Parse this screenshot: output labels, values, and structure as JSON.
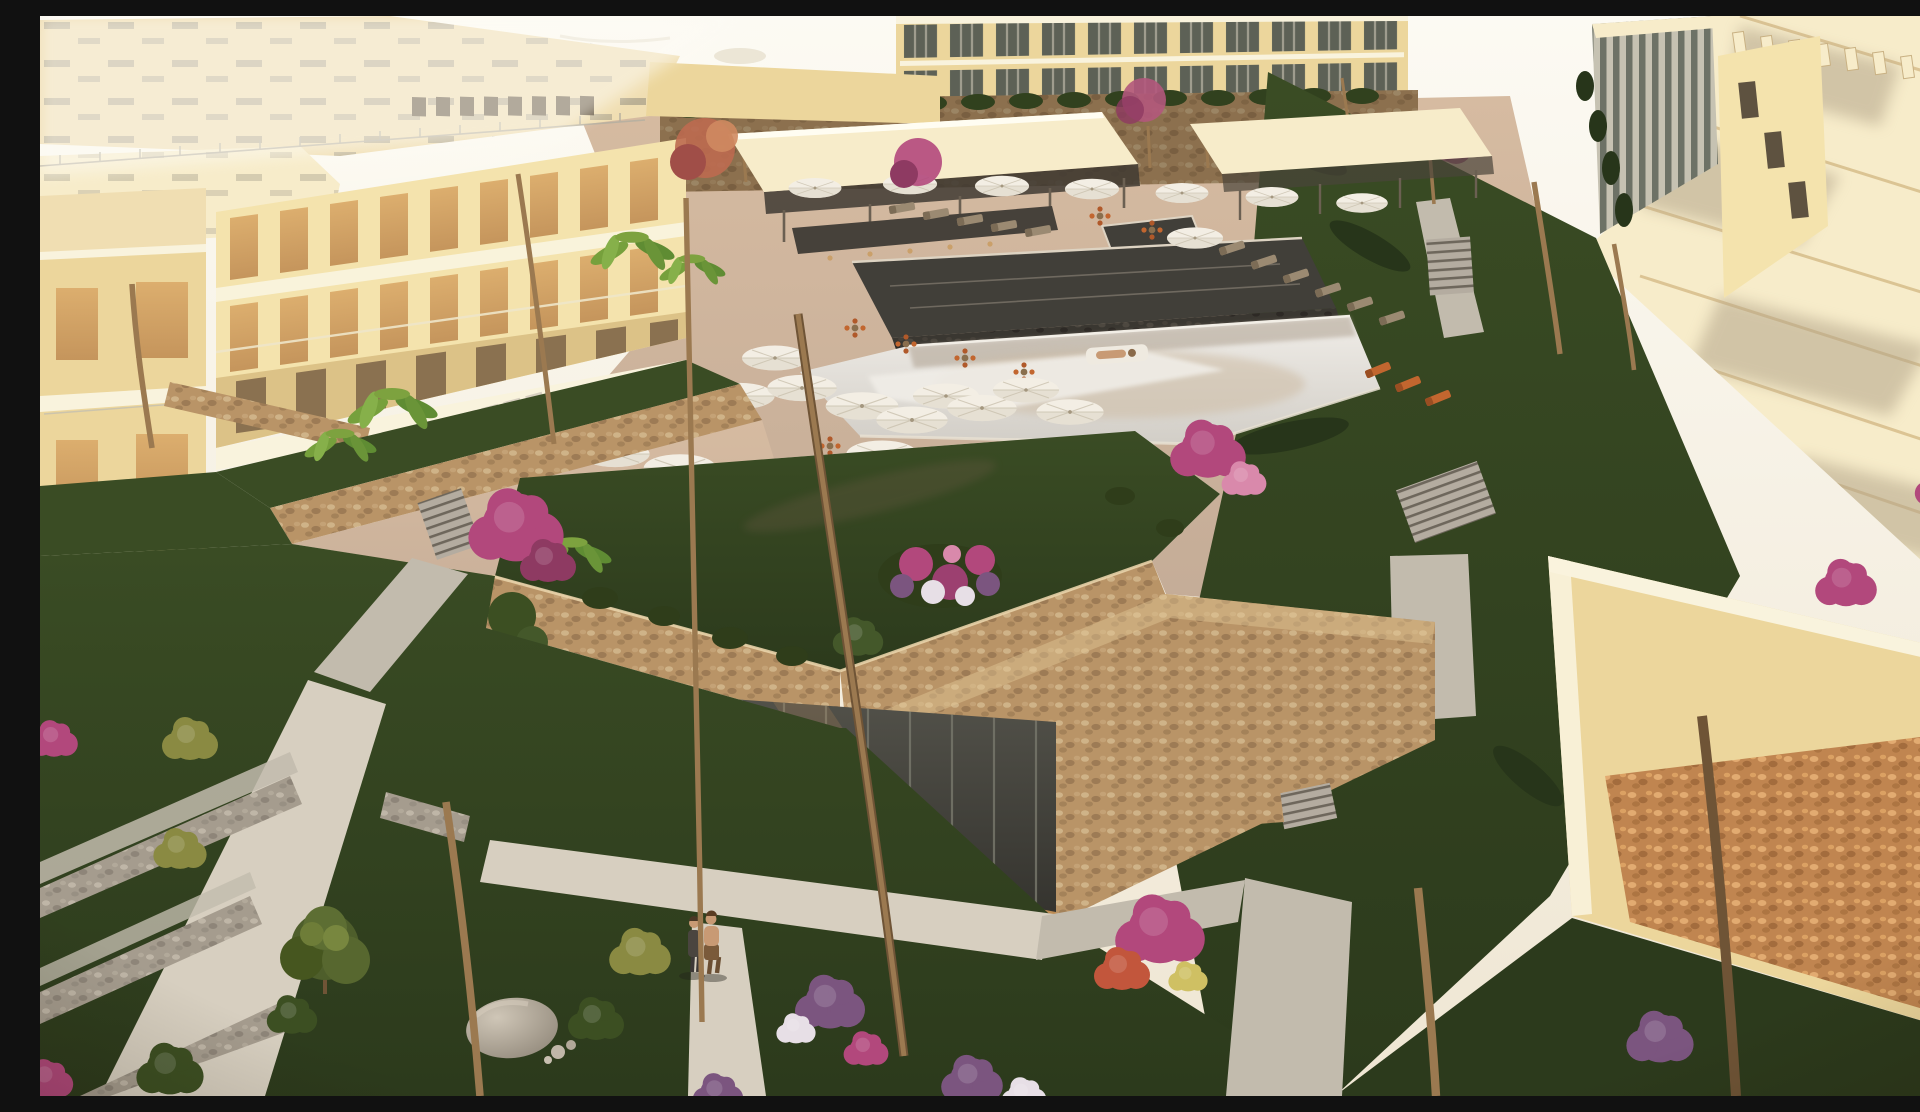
{
  "scene": {
    "caption": "Aerial sunset rendering of a beachfront resort apartment complex with pool courtyard, palm gardens and terraced stone walls",
    "medium": "3D architectural rendering",
    "view": "high aerial three-quarter view",
    "time_of_day": "sunset golden hour, long warm shadows",
    "setting": "beachfront resort / residential complex"
  },
  "elements": {
    "buildings": [
      "left cream apartment wing with two floors of tall warm-lit windows and hatched flat roof",
      "far background hotel block with grey glazed window grid",
      "right cream apartment block with cascading flat roofs, louvered glass box and orange stone-clad base",
      "central clubhouse with planted green roof, pebble stone parapets and dark glass curtain wall over a wood deck with LED strip"
    ],
    "pool_area": {
      "pools": [
        "dark reflecting upper pool",
        "large light main swimming pool"
      ],
      "bar": "swim-up bar pavilion with flat cream roof",
      "shade_pavilion": "flat-roof pergola with sun loungers",
      "umbrellas": "about 20 white parasols on pink-tan paved deck",
      "furniture": "orange cafe chairs, grey and wooden sun loungers",
      "float": "person sunbathing on a white pool float"
    },
    "vegetation": {
      "palms": "many golden backlit palms and small fan palms",
      "flowers": "magenta bougainvillea, purple and white flower beds, yellow-green shrubs",
      "lawns": "dark green terraced lawns with pebble retaining walls",
      "other": "banana plants, dracaenas, hedges, round tree, boulder"
    },
    "circulation": [
      "light gravel garden paths in T junction",
      "several grey staircases",
      "stepping stones across lawn"
    ],
    "people": [
      "couple walking on the lower garden path",
      "bather on pool float"
    ]
  },
  "palette": {
    "sand-bright": "#fcfaf3",
    "sand": "#f5efe1",
    "haze": "#efe6d3",
    "cream-roof": "#f0deb2",
    "cream-roof-lit": "#f7ecca",
    "cream-wall": "#f4e3ad",
    "cream-wall-deep": "#ecd69c",
    "cream-shadow": "#dcc287",
    "fascia": "#f9f3dd",
    "win-warm": "#c5955c",
    "win-warm-lit": "#dcae6e",
    "win-dark": "#6b5a40",
    "glass-grey": "#757a6e",
    "glass-dark": "#3e3e38",
    "mullion": "#c9c4b4",
    "stone": "#b99467",
    "stone-dark": "#8a6b49",
    "stone-grey": "#a59c8e",
    "stone-orange": "#c08550",
    "grass": "#3a4c24",
    "grass-dark": "#2c3a1c",
    "grass-lit": "#5d7030",
    "grass-gold": "#8a8a42",
    "deck": "#c4ac97",
    "deck-lit": "#d6bba1",
    "deck-shadow": "#a88e7c",
    "pool-dark": "#413f39",
    "pool-light": "#e9e6e1",
    "pool-warm": "#cdbca4",
    "path": "#d7cfc0",
    "path-dim": "#c2bbad",
    "umb": "#f3eee4",
    "umb-dim": "#d9d1c1",
    "wood": "#b5854f",
    "wood-lit": "#dca76a",
    "led": "#fff7e0",
    "orange": "#c2662f",
    "magenta": "#b2487c",
    "purple": "#7b557f",
    "bloom-white": "#e7dfe6",
    "bloom-yellow": "#cfc063",
    "palm-dark": "#35461f",
    "palm-mid": "#4c5e28",
    "palm-gold": "#c09c48",
    "palm-pale": "#a9a85a",
    "trunk": "#9b7950",
    "trunk-dark": "#6f5436",
    "rock": "#b3a99c",
    "skin": "#c89a74"
  }
}
